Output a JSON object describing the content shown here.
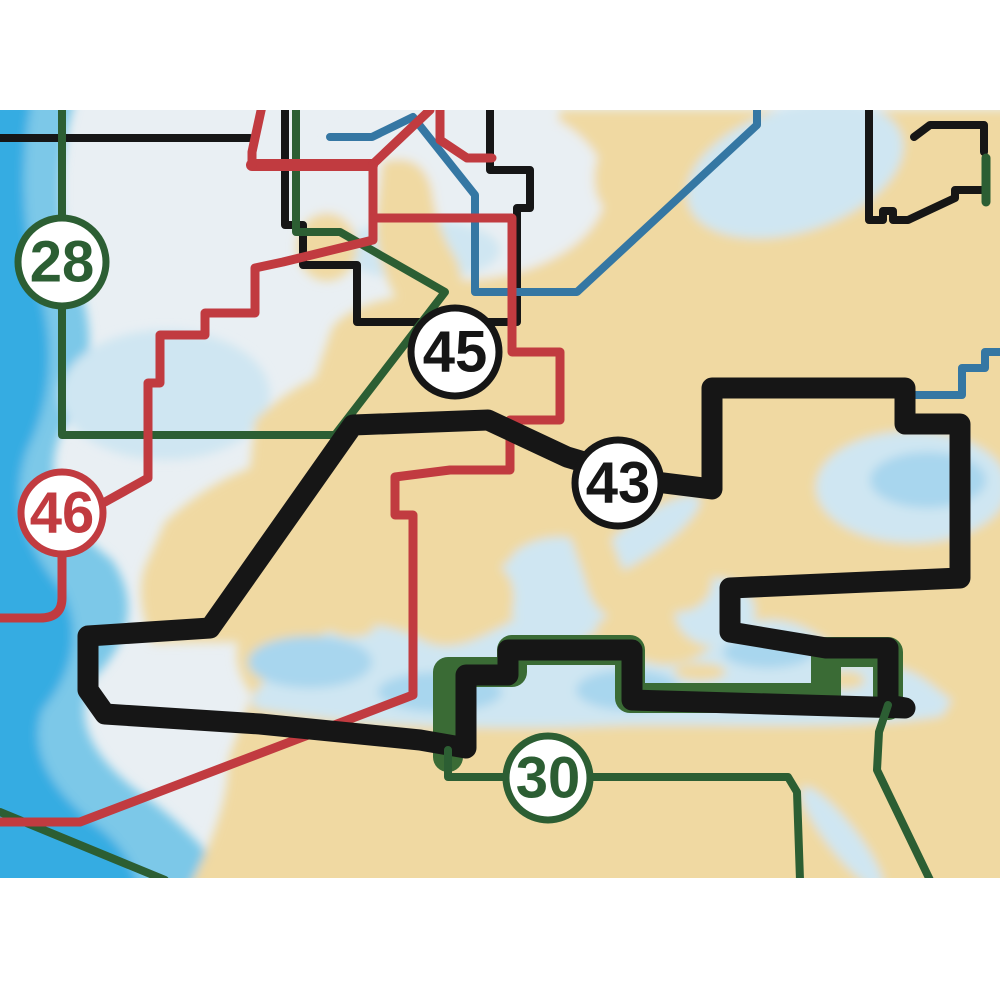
{
  "map": {
    "type": "nautical-chart-coverage-map",
    "description": "Chart region coverage selector map of Europe, North Africa and the Mediterranean",
    "palette": {
      "page_background": "#ffffff",
      "land": "#f0d9a2",
      "sea_pale": "#e9eff3",
      "sea_shallow": "#cfe6f2",
      "sea_patch": "#a8d6ee",
      "sea_mid": "#7cc8e8",
      "sea_deep": "#35ace2",
      "line_black": "#161616",
      "line_green": "#2c5e33",
      "line_green_halo": "#3a6b35",
      "line_red": "#c13b40",
      "line_blue": "#3577a3",
      "badge_fill": "#ffffff"
    },
    "regions": [
      {
        "label": "28",
        "color": "#2c5e33"
      },
      {
        "label": "45",
        "color": "#161616"
      },
      {
        "label": "46",
        "color": "#c13b40"
      },
      {
        "label": "43",
        "color": "#161616"
      },
      {
        "label": "30",
        "color": "#2c5e33"
      }
    ]
  }
}
